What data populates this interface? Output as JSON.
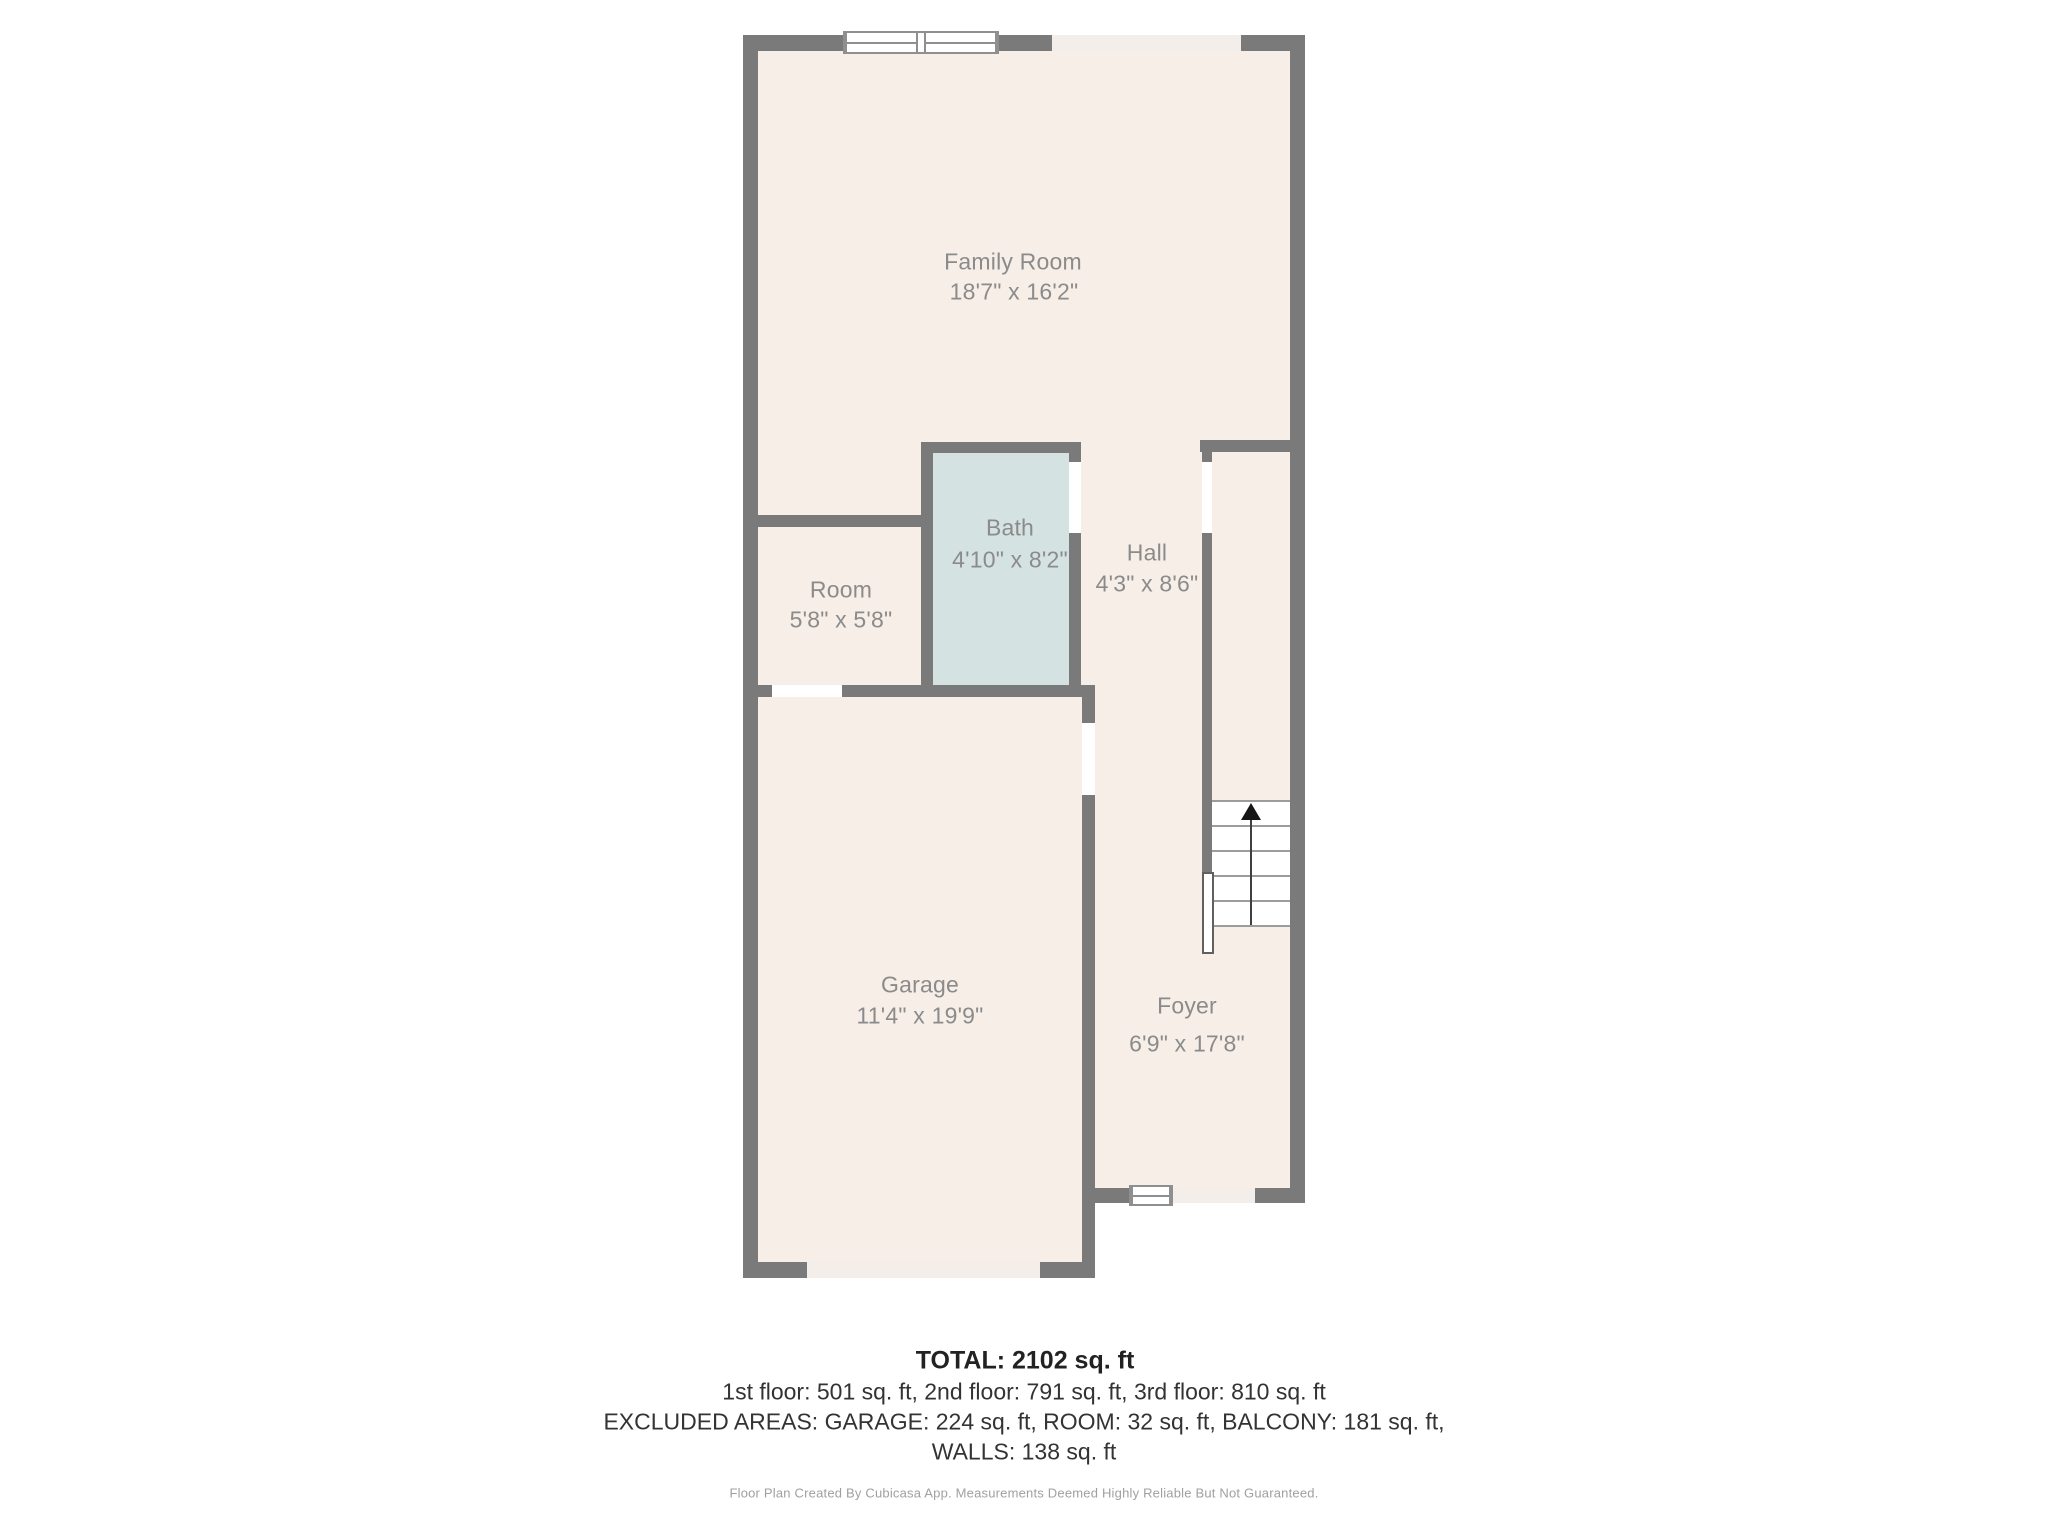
{
  "floor_plan": {
    "rooms": [
      {
        "name": "Family Room",
        "dims": "18'7\" x 16'2\""
      },
      {
        "name": "Room",
        "dims": "5'8\" x 5'8\""
      },
      {
        "name": "Bath",
        "dims": "4'10\" x 8'2\""
      },
      {
        "name": "Hall",
        "dims": "4'3\" x 8'6\""
      },
      {
        "name": "Garage",
        "dims": "11'4\" x 19'9\""
      },
      {
        "name": "Foyer",
        "dims": "6'9\" x 17'8\""
      }
    ],
    "stairs": {
      "direction": "up",
      "treads": 5
    },
    "colors": {
      "wall": "#7a7a7a",
      "floor": "#f6eee7",
      "bath_floor": "#d4e2e2",
      "opening": "#f3eee9",
      "room_label": "#8b8b8b",
      "summary_text": "#333333",
      "disclaimer_text": "#a0a0a0"
    }
  },
  "summary": {
    "total": "TOTAL: 2102 sq. ft",
    "floors": "1st floor: 501 sq. ft, 2nd floor: 791 sq. ft, 3rd floor: 810 sq. ft",
    "excluded": "EXCLUDED AREAS: GARAGE: 224 sq. ft, ROOM: 32 sq. ft, BALCONY: 181 sq. ft,",
    "walls": "WALLS: 138 sq. ft"
  },
  "disclaimer": "Floor Plan Created By Cubicasa App. Measurements Deemed Highly Reliable But Not Guaranteed."
}
